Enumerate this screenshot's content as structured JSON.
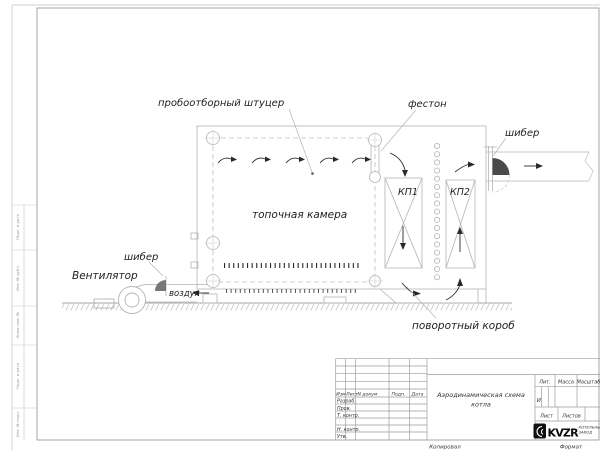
{
  "drawing": {
    "labels": {
      "sampling_fitting": "пробоотборный штуцер",
      "festoon": "фестон",
      "damper_outlet": "шибер",
      "damper_air": "шибер",
      "fan": "Вентилятор",
      "air": "воздух",
      "furnace_chamber": "топочная камера",
      "kp1": "КП1",
      "kp2": "КП2",
      "turning_duct": "поворотный короб"
    }
  },
  "title_block": {
    "cols": {
      "izm": "Изм",
      "list": "Лист",
      "n_dokum": "N докум",
      "podp": "Подп.",
      "data": "Дата"
    },
    "rows": {
      "razrab": "Разраб.",
      "prov": "Пров.",
      "t_kontr": "Т. контр.",
      "n_kontr": "Н. контр.",
      "utv": "Утв."
    },
    "doc_title_line1": "Аэродинамическая схема",
    "doc_title_line2": "котла",
    "lit_label": "Лит.",
    "lit_value": "И",
    "massa_label": "Масса",
    "masshtab_label": "Масштаб",
    "list_label": "Лист",
    "listov_label": "Листов",
    "logo": {
      "text": "KVZR",
      "sub_line1": "КОТЕЛЬНЫЙ",
      "sub_line2": "ЗАВОД"
    },
    "footer": {
      "kopiroval": "Копировал",
      "format": "Формат"
    }
  },
  "margin_stamps": {
    "cell_a": "Подп. и дата",
    "cell_b": "Инв. № дубл.",
    "cell_c": "Взам. инв. №",
    "cell_d": "Подп. и дата",
    "cell_e": "Инв. № подл."
  }
}
